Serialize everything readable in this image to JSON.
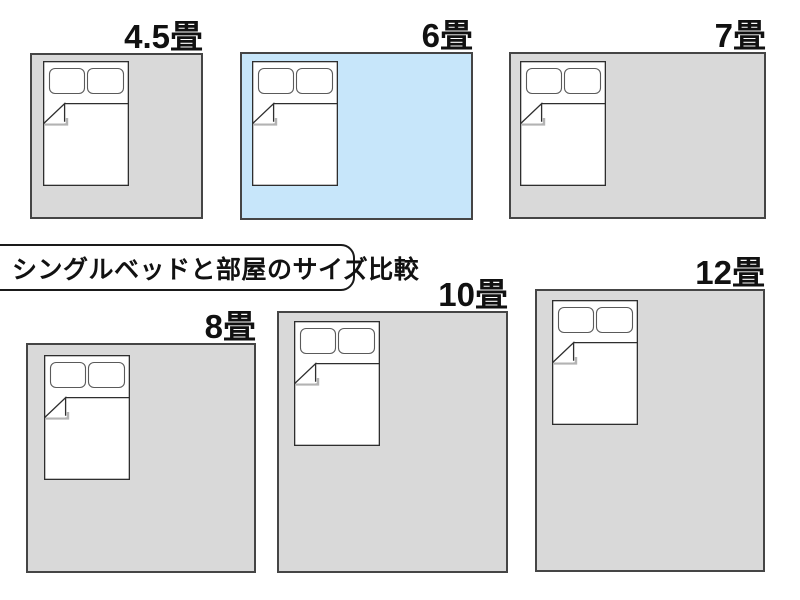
{
  "title": {
    "label": "シングルベッドと部屋のサイズ比較"
  },
  "unit_suffix": "畳",
  "bed_icon": {
    "name": "single-bed-icon",
    "pillow_count": 2
  },
  "colors": {
    "background": "#ffffff",
    "room_fill": "#d9d9d9",
    "room_highlight_fill": "#c7e6fa",
    "room_border": "#454545",
    "bed_fill": "#ffffff",
    "bed_border": "#2e2e2e",
    "fold_shadow": "#b3b3b3",
    "label_color": "#111111",
    "title_border": "#1a1a1a"
  },
  "rooms": [
    {
      "id": "4-5",
      "label": "4.5畳",
      "tatami": 4.5,
      "highlighted": false,
      "geometry": {
        "x": 30,
        "y": 53,
        "w": 173,
        "h": 166,
        "bed_dx": 13,
        "bed_dy": 8
      }
    },
    {
      "id": "6",
      "label": "6畳",
      "tatami": 6,
      "highlighted": true,
      "geometry": {
        "x": 240,
        "y": 52,
        "w": 233,
        "h": 168,
        "bed_dx": 12,
        "bed_dy": 9
      }
    },
    {
      "id": "7",
      "label": "7畳",
      "tatami": 7,
      "highlighted": false,
      "geometry": {
        "x": 509,
        "y": 52,
        "w": 257,
        "h": 167,
        "bed_dx": 11,
        "bed_dy": 9
      }
    },
    {
      "id": "8",
      "label": "8畳",
      "tatami": 8,
      "highlighted": false,
      "geometry": {
        "x": 26,
        "y": 343,
        "w": 230,
        "h": 230,
        "bed_dx": 18,
        "bed_dy": 12
      }
    },
    {
      "id": "10",
      "label": "10畳",
      "tatami": 10,
      "highlighted": false,
      "geometry": {
        "x": 277,
        "y": 311,
        "w": 231,
        "h": 262,
        "bed_dx": 17,
        "bed_dy": 10
      }
    },
    {
      "id": "12",
      "label": "12畳",
      "tatami": 12,
      "highlighted": false,
      "geometry": {
        "x": 535,
        "y": 289,
        "w": 230,
        "h": 283,
        "bed_dx": 17,
        "bed_dy": 11
      }
    }
  ]
}
